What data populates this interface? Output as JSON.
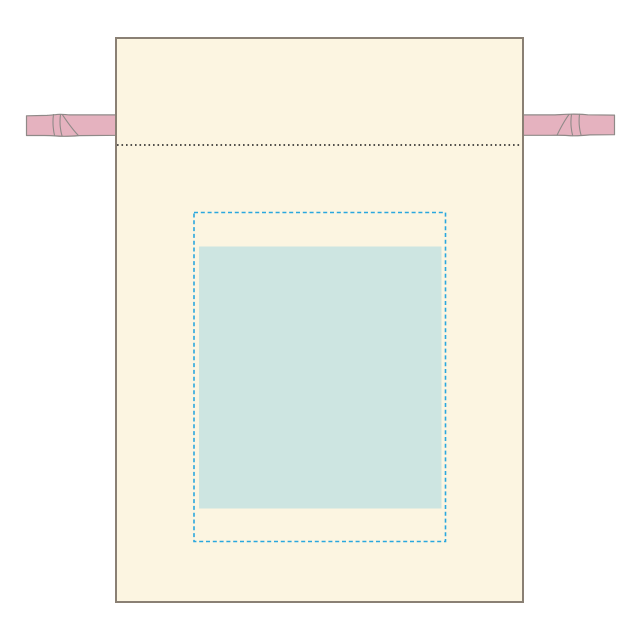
{
  "mockup": {
    "subject": "drawstring-pouch-print-template",
    "elements": {
      "bag": "cream drawstring pouch front view",
      "left_ribbon": "pink drawstring ribbon exiting left side with twist",
      "right_ribbon": "pink drawstring ribbon exiting right side with twist",
      "stitch_line": "black dotted seam line across top channel",
      "print_area": "cyan dashed rectangle marking printable area",
      "design_placeholder": "solid pale teal rectangle marking design placement"
    }
  },
  "colors": {
    "background": "#FFFFFF",
    "bag_fill": "#FCF5E1",
    "bag_outline": "#8A8074",
    "ribbon_fill": "#E5B2BF",
    "ribbon_outline": "#8F8A88",
    "stitch_dotted": "#1A1A1A",
    "print_area_dash": "#2AA7DE",
    "design_fill": "#CDE5E1"
  }
}
